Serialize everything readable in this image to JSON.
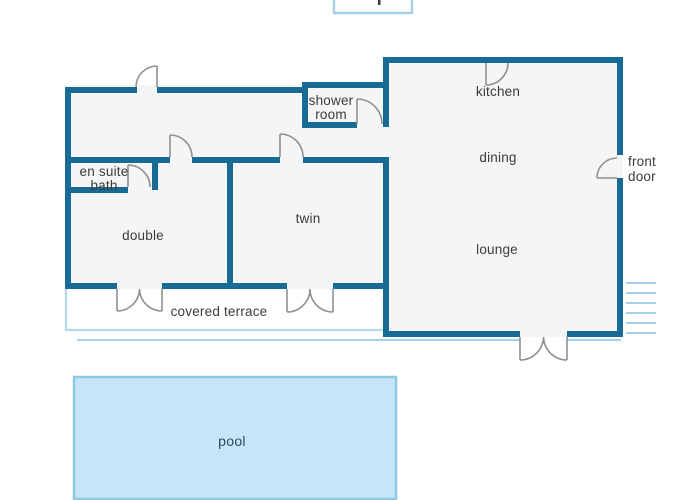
{
  "plan": {
    "labels": {
      "kitchen": "kitchen",
      "dining": "dining",
      "lounge": "lounge",
      "twin": "twin",
      "double": "double",
      "shower_room_line1": "shower",
      "shower_room_line2": "room",
      "en_suite_line1": "en suite",
      "en_suite_line2": "bath",
      "covered_terrace": "covered terrace",
      "front_door_line1": "front",
      "front_door_line2": "door",
      "pool": "pool"
    },
    "colors": {
      "wall": "#176b94",
      "door_symbol": "#919191",
      "light_outline": "#a6d0e8",
      "floor_fill": "#f4f5f6",
      "pool_fill": "#c6e6f7",
      "pool_border": "#90c8e4",
      "pool_text": "#2d4a5f",
      "label_text": "#3b3b3b"
    }
  }
}
